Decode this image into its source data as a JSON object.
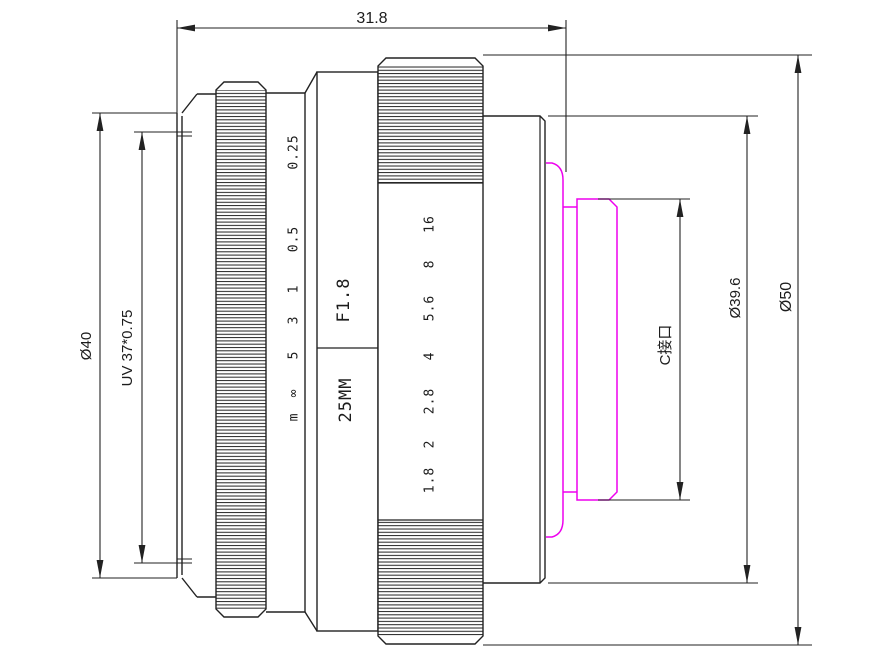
{
  "drawing": {
    "type": "lens-technical-drawing",
    "dims": {
      "overall_length": "31.8",
      "front_diameter": "Ø40",
      "filter_thread": "UV 37*0.75",
      "mount_name": "C接口",
      "mount_diameter": "Ø39.6",
      "outer_diameter": "Ø50"
    },
    "barrel": {
      "focal_length": "25MM",
      "max_aperture": "F1.8"
    },
    "focus_scale": [
      "0.25",
      "0.5",
      "1",
      "3",
      "5",
      "∞",
      "m"
    ],
    "aperture_scale": [
      "16",
      "8",
      "5.6",
      "4",
      "2.8",
      "2",
      "1.8"
    ],
    "colors": {
      "line": "#222222",
      "mount_highlight": "#ee00ee",
      "background": "#ffffff"
    }
  }
}
